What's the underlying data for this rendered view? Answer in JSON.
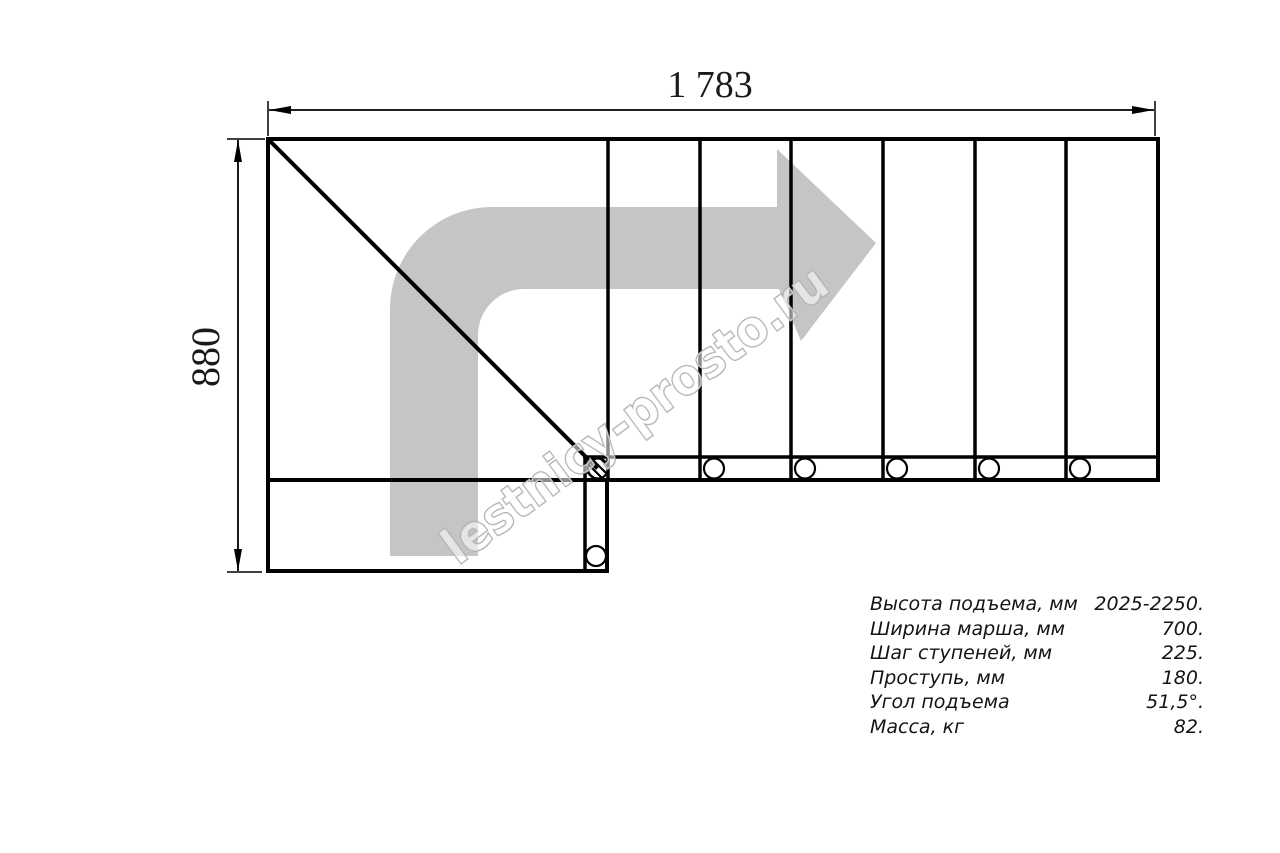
{
  "drawing": {
    "dim_width_label": "1 783",
    "dim_height_label": "880",
    "watermark": "lestnicy-prosto.ru"
  },
  "specs": {
    "rows": [
      {
        "label": "Высота подъема, мм",
        "value": "2025-2250."
      },
      {
        "label": "Ширина марша, мм",
        "value": "700."
      },
      {
        "label": "Шаг ступеней, мм",
        "value": "225."
      },
      {
        "label": "Проступь, мм",
        "value": "180."
      },
      {
        "label": "Угол подъема",
        "value": "51,5°."
      },
      {
        "label": "Масса, кг",
        "value": "82."
      }
    ]
  },
  "colors": {
    "line_black": "#000000",
    "arrow_gray": "#c5c5c5",
    "watermark_gray": "#a6a6a6"
  }
}
